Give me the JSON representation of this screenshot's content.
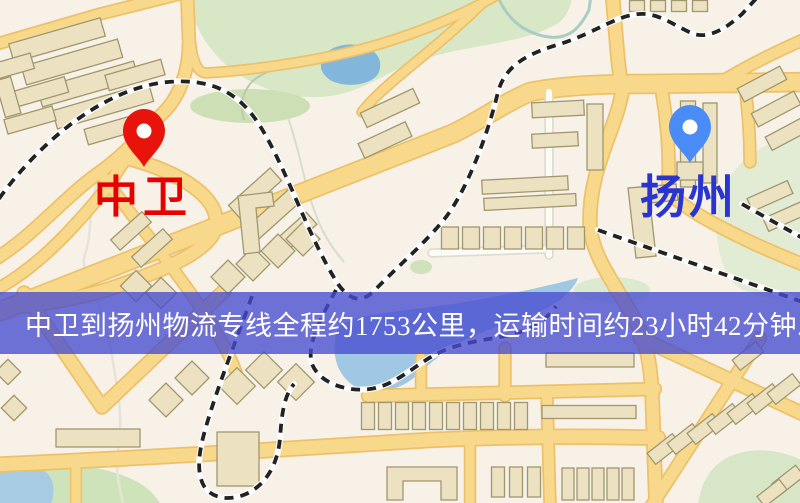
{
  "banner": {
    "text": "中卫到扬州物流专线全程约1753公里，运输时间约23小时42分钟.",
    "bg": "rgba(70,75,208,0.78)",
    "text_color": "#ffffff"
  },
  "markers": [
    {
      "id": "origin",
      "label": "中卫",
      "pin_color": "#e8130a",
      "label_color": "#e60000",
      "x": 144,
      "y": 167,
      "label_x": 94,
      "label_y": 176,
      "label_size": 44,
      "label_spacing": 5
    },
    {
      "id": "destination",
      "label": "扬州",
      "pin_color": "#4a8cf5",
      "label_color": "#2a35cf",
      "x": 690,
      "y": 163,
      "label_x": 640,
      "label_y": 175,
      "label_size": 46,
      "label_spacing": 2
    }
  ],
  "map": {
    "bg": "#f7f1e8",
    "road_fill": "#f8d98c",
    "road_casing": "#edc169",
    "white_road_fill": "#fcfcf6",
    "white_road_casing": "#e1dcd0",
    "rail_casing": "#fdfdfd",
    "rail_dash": "#222222",
    "building_fill": "#ece2c2",
    "building_stroke": "#a0976e",
    "greens": [
      {
        "d": "M185,-8 C194,30 214,62 248,80 C272,93 300,100 330,96 C356,92 372,82 392,72 C420,58 448,52 470,48 C500,42 536,38 560,22 C568,14 572,4 572,-8 Z",
        "fill": "#d8e7c5"
      },
      {
        "e": [
          250,
          106,
          60,
          17
        ],
        "fill": "#cde0b5"
      },
      {
        "d": "M812,126 C772,138 736,158 723,190 C712,220 716,256 730,279 C742,296 772,301 812,298 Z",
        "fill": "#e2ecd5"
      },
      {
        "d": "M-8,472 C30,462 62,461 96,468 C130,475 152,486 162,507 L-8,507 Z",
        "fill": "#cfe3bb"
      },
      {
        "d": "M698,507 C700,482 712,462 736,454 C762,446 790,452 812,466 L812,507 Z",
        "fill": "#d6e6c6"
      },
      {
        "e": [
          612,
          290,
          38,
          13
        ],
        "fill": "#dcead0"
      },
      {
        "e": [
          421,
          267,
          11,
          7
        ],
        "fill": "#cfe3bb"
      }
    ],
    "waters": [
      {
        "d": "M322,60 C327,46 347,42 362,46 C378,50 384,62 378,74 C370,86 344,88 330,80 C322,74 319,68 322,60 Z",
        "fill": "#82b6db"
      },
      {
        "d": "M338,328 C330,352 336,374 354,386 C372,396 398,392 416,376 C434,360 452,344 478,334 C506,322 538,316 560,300 C570,292 576,284 578,278 C540,288 500,296 466,302 C430,308 380,312 358,318 C348,321 341,324 338,328 Z",
        "fill": "#a0c7e3"
      },
      {
        "d": "M-5,458 C15,458 35,462 48,474 C56,484 54,496 50,507 L-5,507 Z",
        "fill": "#a6cbe3"
      }
    ],
    "streams": [
      {
        "d": "M97,182 C88,212 92,236 85,254 C80,270 92,284 98,302 C104,322 110,342 113,362 C119,397 123,422 118,452 C115,472 120,490 124,507",
        "s": "#e7e3d7",
        "w": 2.5
      },
      {
        "d": "M497,-5 C505,14 518,30 543,36 C568,42 580,28 589,10 L591,-5",
        "s": "#a9cdc4",
        "w": 3
      },
      {
        "d": "M418,28 C375,42 340,60 310,63 C280,66 260,72 250,84 C242,94 240,106 244,120",
        "s": "#b8c9ae",
        "w": 2
      },
      {
        "d": "M288,118 C300,150 304,185 316,215 C322,232 332,248 344,262",
        "s": "#d9dccf",
        "w": 2
      }
    ],
    "roads": [
      {
        "d": "M-12,316 L452,134 C478,122 502,104 530,92 C560,86 600,84 640,84 L812,82",
        "w": 17
      },
      {
        "d": "M-10,262 C30,240 65,196 100,172 C125,154 142,134 162,114 C180,97 189,70 189,42 L187,-10",
        "w": 11
      },
      {
        "d": "M-10,293 C35,270 70,232 100,196 C110,184 117,172 125,160",
        "w": 10
      },
      {
        "d": "M123,157 C182,172 220,198 216,226 C212,252 158,272 112,288 C80,298 40,306 -10,309",
        "w": 12
      },
      {
        "d": "M104,178 C140,226 170,263 196,301 C214,328 228,350 236,372",
        "w": 10
      },
      {
        "d": "M506,-10 C462,16 420,32 380,44 C330,59 258,70 206,73 C197,73 192,58 191,44",
        "w": 8
      },
      {
        "d": "M496,-10 C458,28 428,52 400,75 C386,87 372,99 362,112",
        "w": 8
      },
      {
        "d": "M612,-10 L618,60 C620,78 622,88 622,92 C616,130 588,170 590,225 C592,258 618,288 636,322 C646,342 650,360 652,392 L656,505",
        "w": 12
      },
      {
        "d": "M662,92 C668,128 670,160 668,192 C690,215 755,246 812,268",
        "w": 11
      },
      {
        "d": "M745,86 C748,110 750,135 750,162",
        "w": 10
      },
      {
        "d": "M-10,46 L100,14 L196,-10",
        "w": 10
      },
      {
        "d": "M812,36 C770,54 740,70 716,85",
        "w": 10
      },
      {
        "d": "M640,338 L816,420",
        "w": 12
      },
      {
        "d": "M760,338 L652,505",
        "w": 11
      },
      {
        "d": "M368,396 L655,389",
        "w": 11
      },
      {
        "d": "M-10,465 C150,458 300,448 430,440 C520,436 590,436 658,438",
        "w": 13
      },
      {
        "d": "M547,396 L550,505",
        "w": 10
      },
      {
        "d": "M505,348 L505,396",
        "w": 10
      },
      {
        "d": "M24,293 L102,407 L224,291",
        "w": 12
      },
      {
        "d": "M76,460 L76,505",
        "w": 9
      },
      {
        "d": "M470,442 L470,505",
        "w": 9
      },
      {
        "d": "M421,358 L421,396",
        "w": 9
      },
      {
        "d": "M549,92 L549,255",
        "w": 6,
        "white": true
      },
      {
        "d": "M432,253 L549,249",
        "w": 6,
        "white": true
      }
    ],
    "railways": [
      "M-10,212 C30,150 100,88 168,82 C225,77 248,104 266,136 C292,183 310,240 338,284 C350,301 362,303 374,291 C398,266 420,248 442,222 C466,194 488,134 498,92 C506,62 534,52 560,44 C598,32 620,12 646,14 C664,16 678,28 694,34 C710,39 728,27 742,14 L764,-10",
      "M336,290 C322,316 306,344 312,364 C320,384 348,392 370,389 C394,386 414,366 436,354 C462,341 490,340 514,334 C534,329 548,318 556,306",
      "M252,296 C238,336 220,380 208,420 C200,446 196,466 202,482 C208,498 228,502 246,494 C266,485 278,464 280,438 C282,412 284,396 294,384",
      "M598,230 L814,306",
      "M742,204 L806,240"
    ],
    "buildings": [
      [
        57,
        40,
        95,
        19,
        -16
      ],
      [
        72,
        62,
        100,
        19,
        -16
      ],
      [
        88,
        84,
        100,
        19,
        -16
      ],
      [
        103,
        106,
        100,
        19,
        -16
      ],
      [
        40,
        92,
        55,
        16,
        -16
      ],
      [
        14,
        66,
        38,
        16,
        -16
      ],
      [
        8,
        97,
        16,
        38,
        -16
      ],
      [
        30,
        120,
        50,
        15,
        -16
      ],
      [
        135,
        75,
        58,
        16,
        -16
      ],
      [
        118,
        128,
        66,
        16,
        -16
      ],
      [
        131,
        231,
        42,
        14,
        -42
      ],
      [
        152,
        248,
        42,
        14,
        -42
      ],
      [
        255,
        193,
        56,
        17,
        -42
      ],
      [
        274,
        214,
        56,
        17,
        -42
      ],
      [
        293,
        235,
        50,
        16,
        -42
      ],
      [
        136,
        286,
        22,
        22,
        45
      ],
      [
        161,
        293,
        22,
        22,
        45
      ],
      [
        228,
        277,
        24,
        24,
        45
      ],
      [
        253,
        264,
        24,
        24,
        45
      ],
      [
        278,
        251,
        24,
        24,
        45
      ],
      [
        303,
        239,
        24,
        24,
        45
      ],
      [
        390,
        108,
        58,
        16,
        -25
      ],
      [
        385,
        140,
        52,
        16,
        -25
      ],
      [
        558,
        109,
        52,
        15,
        -3
      ],
      [
        555,
        140,
        46,
        14,
        -3
      ],
      [
        595,
        137,
        16,
        66,
        0
      ],
      [
        525,
        185,
        86,
        14,
        -3
      ],
      [
        530,
        202,
        92,
        12,
        -3
      ],
      [
        450,
        238,
        17,
        22,
        0
      ],
      [
        471,
        238,
        17,
        22,
        0
      ],
      [
        492,
        238,
        17,
        22,
        0
      ],
      [
        513,
        238,
        17,
        22,
        0
      ],
      [
        534,
        238,
        17,
        22,
        0
      ],
      [
        555,
        238,
        17,
        22,
        0
      ],
      [
        576,
        238,
        17,
        22,
        0
      ],
      [
        637,
        6,
        15,
        11,
        0
      ],
      [
        658,
        6,
        15,
        11,
        0
      ],
      [
        679,
        6,
        15,
        11,
        0
      ],
      [
        700,
        6,
        15,
        11,
        0
      ],
      [
        688,
        144,
        15,
        86,
        0
      ],
      [
        710,
        143,
        14,
        80,
        0
      ],
      [
        690,
        171,
        26,
        18,
        0
      ],
      [
        762,
        84,
        48,
        15,
        -28
      ],
      [
        776,
        109,
        48,
        15,
        -28
      ],
      [
        789,
        133,
        46,
        15,
        -28
      ],
      [
        770,
        196,
        44,
        14,
        -24
      ],
      [
        786,
        216,
        44,
        14,
        -24
      ],
      [
        98,
        438,
        84,
        18,
        0
      ],
      [
        238,
        459,
        42,
        54,
        0
      ],
      [
        166,
        400,
        24,
        24,
        45
      ],
      [
        192,
        378,
        24,
        24,
        45
      ],
      [
        237,
        386,
        26,
        26,
        45
      ],
      [
        264,
        370,
        26,
        26,
        45
      ],
      [
        296,
        382,
        26,
        26,
        45
      ],
      [
        8,
        372,
        18,
        18,
        45
      ],
      [
        14,
        408,
        18,
        18,
        45
      ],
      [
        368,
        416,
        13,
        27,
        0
      ],
      [
        385,
        416,
        13,
        27,
        0
      ],
      [
        402,
        416,
        13,
        27,
        0
      ],
      [
        419,
        416,
        13,
        27,
        0
      ],
      [
        436,
        416,
        13,
        27,
        0
      ],
      [
        453,
        416,
        13,
        27,
        0
      ],
      [
        470,
        416,
        13,
        27,
        0
      ],
      [
        487,
        416,
        13,
        27,
        0
      ],
      [
        504,
        416,
        13,
        27,
        0
      ],
      [
        521,
        416,
        13,
        27,
        0
      ],
      [
        589,
        412,
        94,
        13,
        0
      ],
      [
        590,
        360,
        88,
        14,
        0
      ],
      [
        498,
        482,
        13,
        30,
        0
      ],
      [
        516,
        482,
        13,
        30,
        0
      ],
      [
        534,
        482,
        13,
        30,
        0
      ],
      [
        568,
        484,
        12,
        32,
        0
      ],
      [
        583,
        484,
        12,
        32,
        0
      ],
      [
        598,
        484,
        12,
        32,
        0
      ],
      [
        613,
        484,
        12,
        32,
        0
      ],
      [
        628,
        484,
        12,
        32,
        0
      ],
      [
        664,
        449,
        32,
        14,
        -38
      ],
      [
        684,
        439,
        32,
        14,
        -38
      ],
      [
        704,
        429,
        32,
        14,
        -38
      ],
      [
        724,
        419,
        32,
        14,
        -38
      ],
      [
        744,
        409,
        32,
        14,
        -38
      ],
      [
        764,
        399,
        32,
        14,
        -38
      ],
      [
        784,
        389,
        32,
        14,
        -38
      ],
      [
        788,
        480,
        30,
        14,
        -38
      ],
      [
        772,
        493,
        28,
        13,
        -38
      ],
      [
        748,
        356,
        30,
        13,
        -38
      ]
    ],
    "building_paths": [
      "M238,196 L272,192 L274,206 L256,208 L260,252 L244,254 Z",
      "M628,188 L676,184 L678,200 L650,203 L656,256 L636,258 Z",
      "M387,467 L457,467 L457,500 L441,500 L441,481 L403,481 L403,500 L387,500 Z"
    ]
  }
}
